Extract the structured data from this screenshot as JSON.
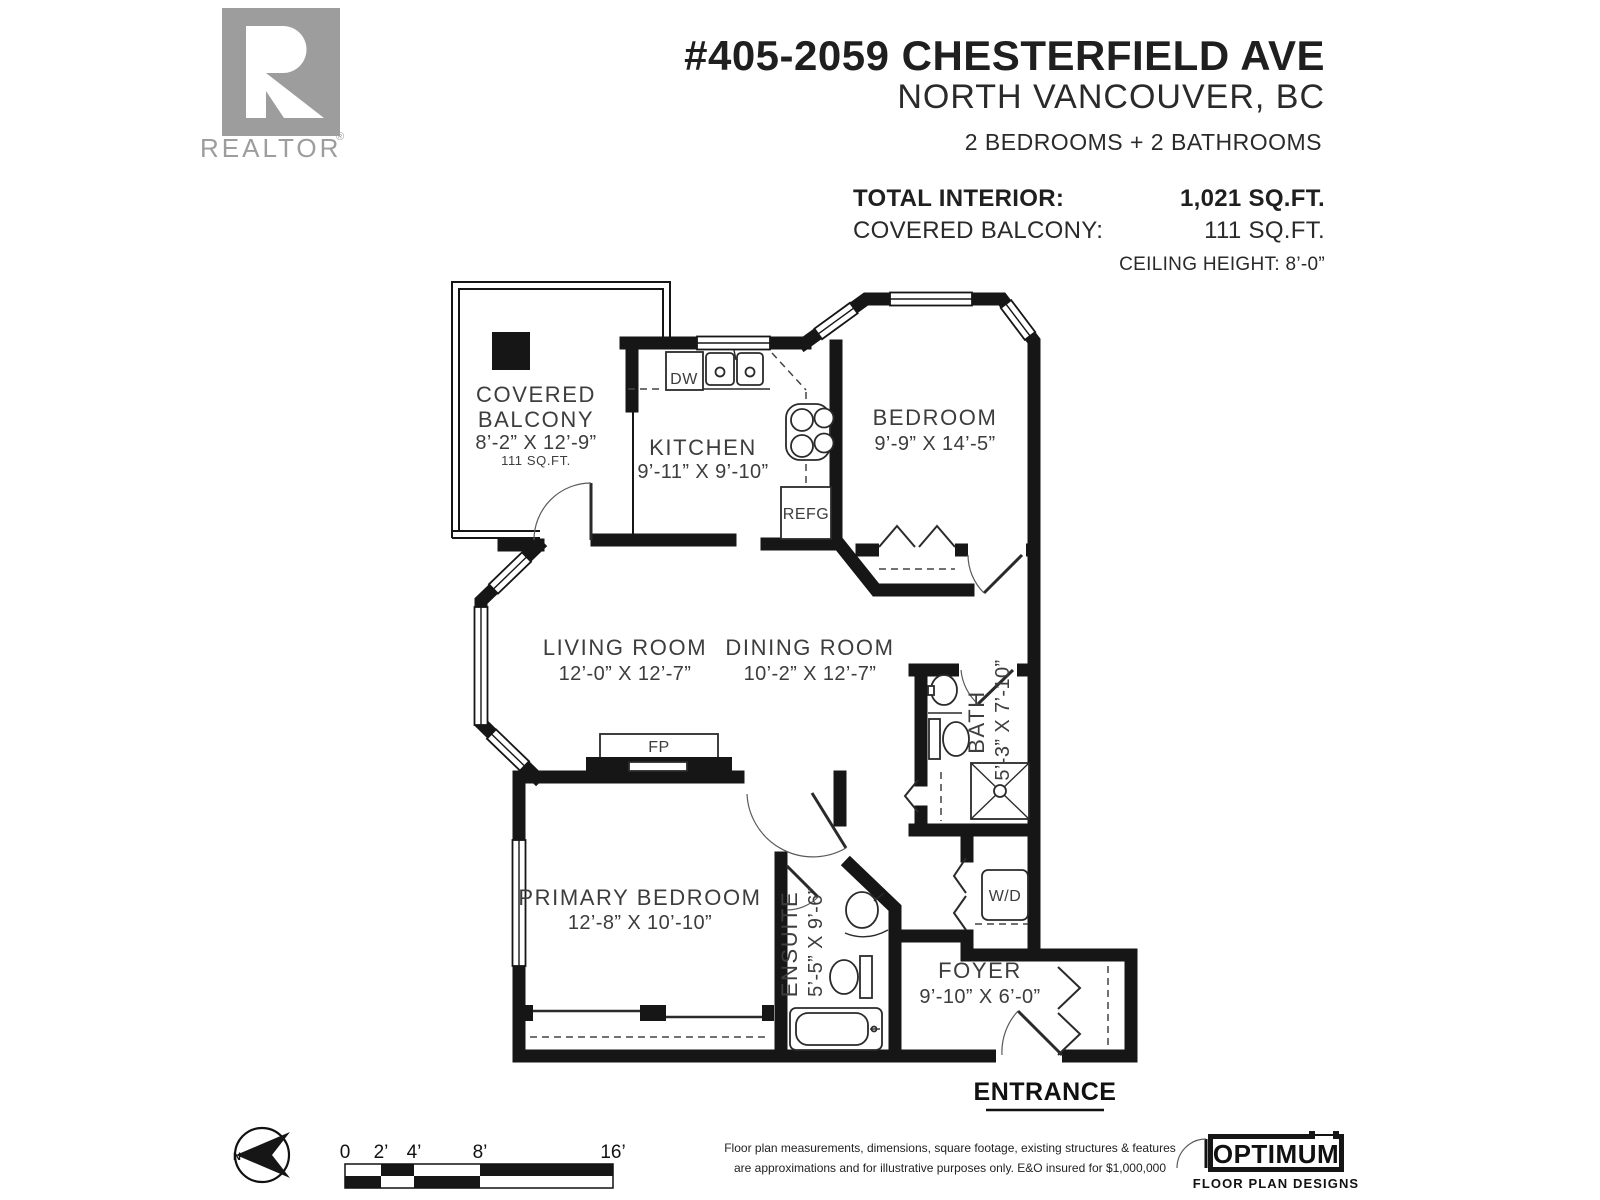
{
  "branding": {
    "realtor_r": "R",
    "realtor_wordmark": "REALTOR",
    "registered_mark": "®"
  },
  "header": {
    "address": "#405-2059 CHESTERFIELD AVE",
    "city": "NORTH VANCOUVER, BC",
    "beds_baths": "2 BEDROOMS + 2 BATHROOMS",
    "stats": [
      {
        "label": "TOTAL INTERIOR:",
        "value": "1,021 SQ.FT."
      },
      {
        "label": "COVERED BALCONY:",
        "value": "111 SQ.FT."
      }
    ],
    "ceiling": "CEILING HEIGHT: 8’-0”"
  },
  "rooms": {
    "balcony": {
      "line1": "COVERED",
      "line2": "BALCONY",
      "dims": "8’-2” X 12’-9”",
      "area": "111 SQ.FT."
    },
    "kitchen": {
      "name": "KITCHEN",
      "dims": "9’-11” X 9’-10”"
    },
    "bedroom": {
      "name": "BEDROOM",
      "dims": "9’-9” X 14’-5”"
    },
    "living": {
      "name": "LIVING ROOM",
      "dims": "12’-0” X 12’-7”"
    },
    "dining": {
      "name": "DINING ROOM",
      "dims": "10’-2” X 12’-7”"
    },
    "bath": {
      "name": "BATH",
      "dims": "5’-3” X 7’-10”"
    },
    "primary": {
      "name": "PRIMARY BEDROOM",
      "dims": "12’-8” X 10’-10”"
    },
    "ensuite": {
      "name": "ENSUITE",
      "dims": "5’-5” X 9’-6”"
    },
    "foyer": {
      "name": "FOYER",
      "dims": "9’-10” X 6’-0”"
    }
  },
  "fixtures": {
    "dishwasher": "DW",
    "refrigerator": "REFG",
    "fireplace": "FP",
    "washer_dryer": "W/D"
  },
  "entrance_label": "ENTRANCE",
  "compass": {
    "north": "N"
  },
  "scale_bar": {
    "ticks": [
      "0",
      "2’",
      "4’",
      "8’",
      "16’"
    ]
  },
  "disclaimer": {
    "line1": "Floor plan measurements, dimensions, square footage, existing structures & features",
    "line2": "are approximations and for illustrative purposes only.  E&O insured for $1,000,000"
  },
  "footer_logo": {
    "name": "OPTIMUM",
    "tagline": "FLOOR PLAN DESIGNS"
  }
}
